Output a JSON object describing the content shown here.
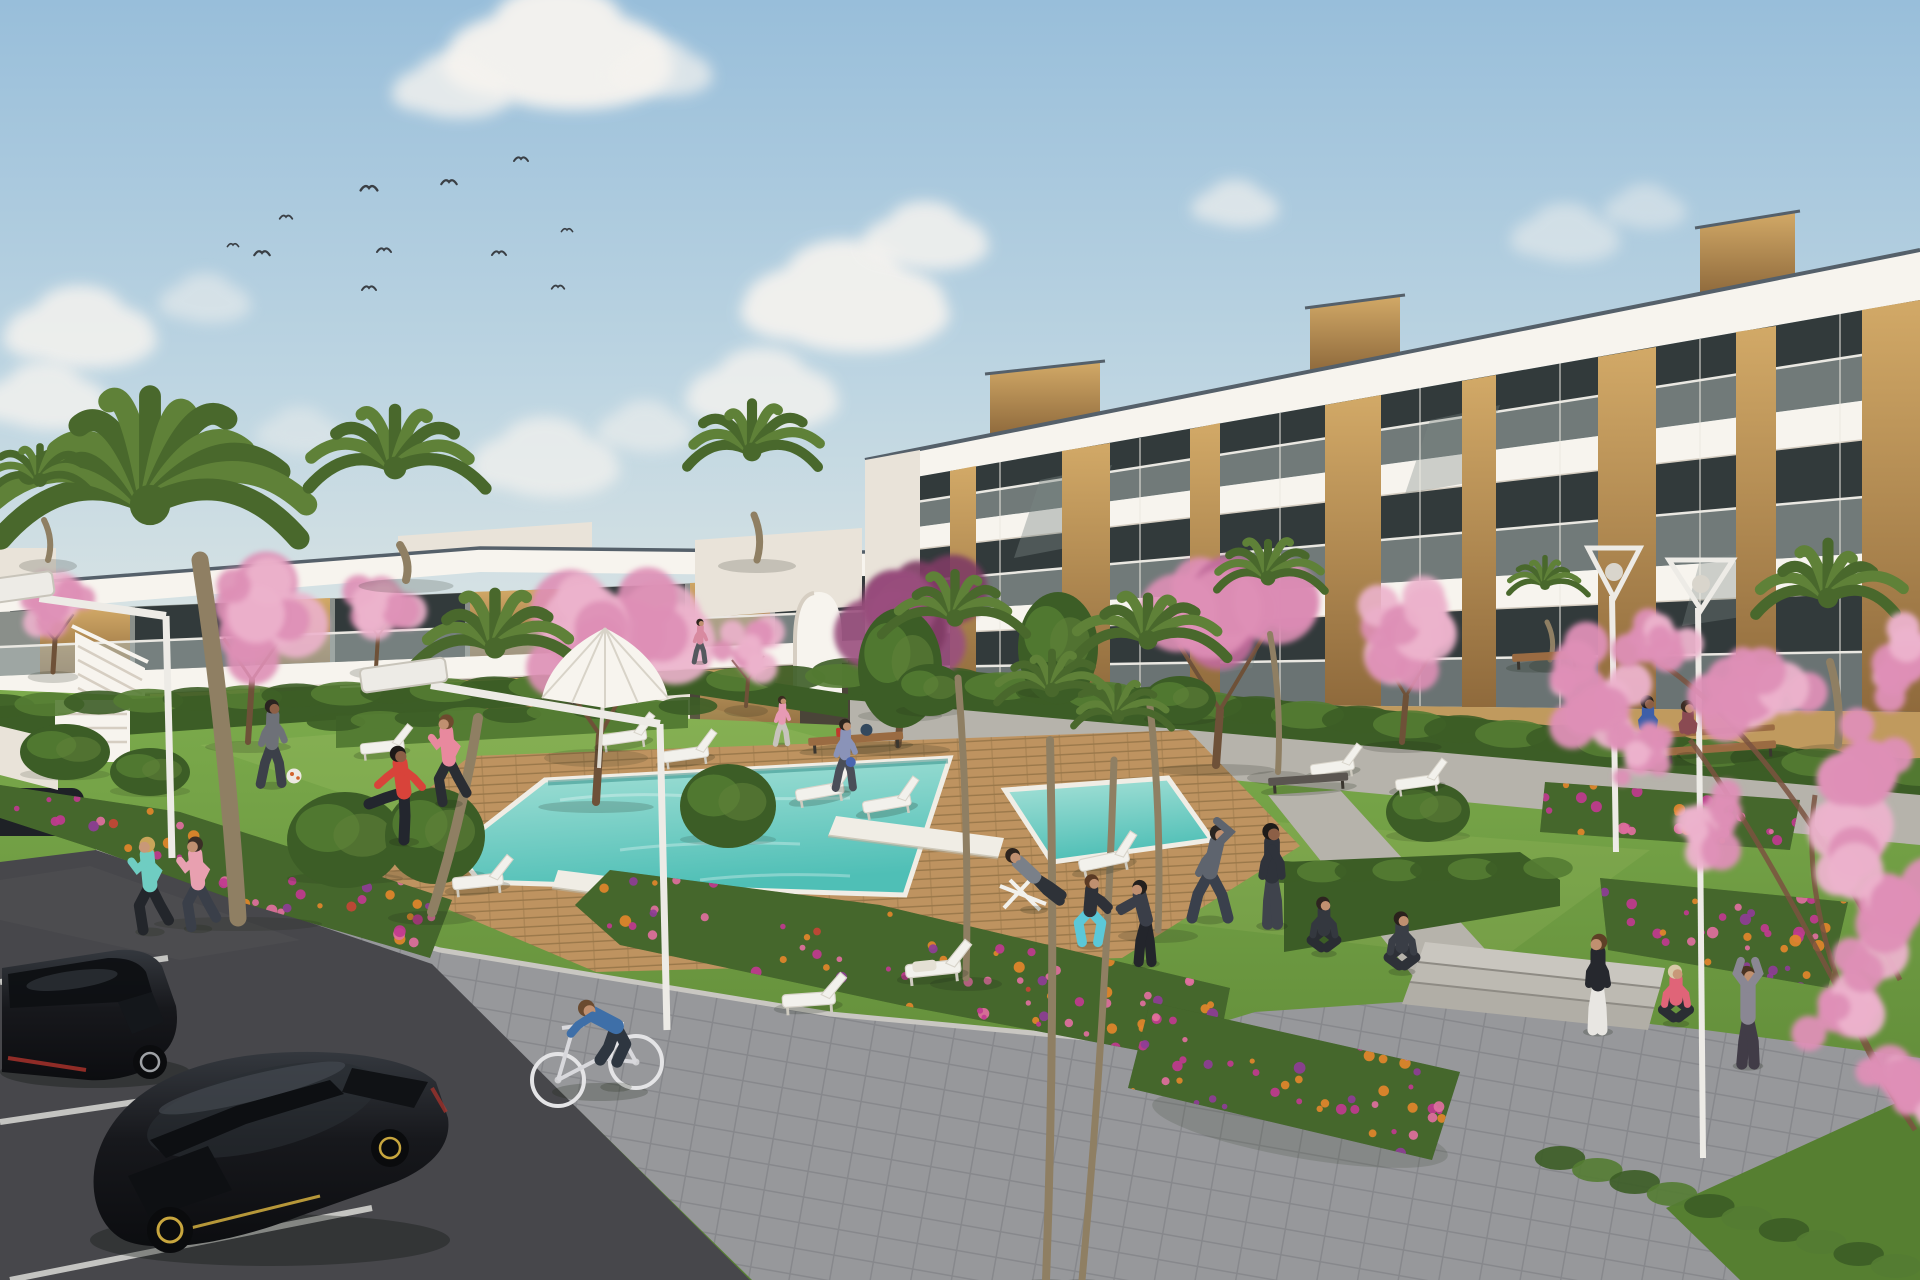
{
  "scene": {
    "type": "architectural-render",
    "subject": "modern white apartment complex with communal pool, gardens, parking and people exercising"
  },
  "palette": {
    "sky-top": "#98BEDA",
    "sky-mid": "#BFD6E2",
    "sky-horizon": "#DAE4E4",
    "cloud": "#F5F3EF",
    "bird": "#3A3F45",
    "white-sun": "#F7F4EE",
    "white-shade": "#E9E3D9",
    "slab-shadow": "#D6CEC2",
    "coping-dark": "#55606A",
    "glass-dark": "#323A3B",
    "glass-mid": "#5E6A68",
    "glass-ref": "#7A8784",
    "balustrade": "#AFBAB8",
    "rail": "#EAE8E2",
    "wood-light": "#D2A967",
    "wood-mid": "#BA8E52",
    "wood-dark": "#8F6A3C",
    "tan-wall": "#C09A5E",
    "hedge-dark": "#3C5D26",
    "hedge-light": "#547C33",
    "lawn-light": "#7CAB4C",
    "lawn-dark": "#567F31",
    "lawn-deep": "#486E2A",
    "sun-patch": "#D9E48A",
    "deck-light": "#BE9360",
    "deck-dark": "#9A784A",
    "pool-far": "#A9E2D8",
    "pool-near": "#4FBFB6",
    "pool-shadow": "#2E8A84",
    "coping": "#F0EDE5",
    "flower-orange": "#E2862B",
    "flower-pink": "#E06F9E",
    "flower-magenta": "#C0398F",
    "flower-violet": "#8E3D96",
    "flower-red": "#C44536",
    "bed-green": "#3E5D28",
    "blossom-light": "#ECB3CC",
    "blossom-mid": "#DE8FB6",
    "blossom-deep": "#C06A9A",
    "leaf-purple": "#9A4F7E",
    "leaf-purple-dark": "#7E3C64",
    "palm-green": "#5F8138",
    "palm-dark": "#49682C",
    "trunk": "#8F7F63",
    "branch": "#7A5240",
    "asphalt": "#47474B",
    "asphalt-light": "#55555A",
    "line-white": "#DADAD6",
    "curb": "#C9C7C2",
    "paver": "#97989B",
    "paver-line": "#87888C",
    "concrete": "#B6B3AB",
    "step-light": "#C9C6BF",
    "step-mid": "#BDBAB2",
    "step-deep": "#B1AEA6",
    "lamp-white": "#EDEBE6",
    "lamp-shade": "#C8C4BA",
    "car-black": "#17181C",
    "car-high": "#3A4046",
    "car-glass": "#0E1013",
    "rim-silver": "#9FA2A6",
    "rim-yellow": "#C8A63E",
    "tail-red": "#B0342C",
    "bench-wood": "#9A6B42",
    "bench-dark": "#5A5550",
    "shadow": "#1A2414"
  },
  "clouds": [
    {
      "x": 558,
      "y": 52,
      "r": 105,
      "o": 0.97
    },
    {
      "x": 452,
      "y": 88,
      "r": 55,
      "o": 0.8
    },
    {
      "x": 660,
      "y": 70,
      "r": 48,
      "o": 0.7
    },
    {
      "x": 80,
      "y": 330,
      "r": 70,
      "o": 0.85
    },
    {
      "x": 45,
      "y": 398,
      "r": 58,
      "o": 0.8
    },
    {
      "x": 205,
      "y": 300,
      "r": 42,
      "o": 0.5
    },
    {
      "x": 545,
      "y": 460,
      "r": 68,
      "o": 0.7
    },
    {
      "x": 645,
      "y": 428,
      "r": 44,
      "o": 0.55
    },
    {
      "x": 300,
      "y": 432,
      "r": 40,
      "o": 0.4
    },
    {
      "x": 845,
      "y": 300,
      "r": 95,
      "o": 0.92
    },
    {
      "x": 762,
      "y": 392,
      "r": 70,
      "o": 0.8
    },
    {
      "x": 925,
      "y": 238,
      "r": 58,
      "o": 0.85
    },
    {
      "x": 1235,
      "y": 205,
      "r": 40,
      "o": 0.65
    },
    {
      "x": 1565,
      "y": 235,
      "r": 50,
      "o": 0.5
    },
    {
      "x": 1645,
      "y": 208,
      "r": 38,
      "o": 0.45
    }
  ],
  "birds": [
    {
      "x": 369,
      "y": 188,
      "s": 1.2
    },
    {
      "x": 449,
      "y": 182,
      "s": 1.1
    },
    {
      "x": 521,
      "y": 159,
      "s": 1.0
    },
    {
      "x": 286,
      "y": 217,
      "s": 0.9
    },
    {
      "x": 233,
      "y": 245,
      "s": 0.8
    },
    {
      "x": 262,
      "y": 253,
      "s": 1.1
    },
    {
      "x": 384,
      "y": 250,
      "s": 1.0
    },
    {
      "x": 499,
      "y": 253,
      "s": 1.0
    },
    {
      "x": 369,
      "y": 288,
      "s": 1.0
    },
    {
      "x": 558,
      "y": 287,
      "s": 0.9
    },
    {
      "x": 567,
      "y": 230,
      "s": 0.8
    }
  ],
  "palms": [
    {
      "x": 150,
      "y": 505,
      "r": 168,
      "t": [
        200,
        560,
        238,
        918
      ],
      "w": 17,
      "big": true
    },
    {
      "x": 40,
      "y": 480,
      "r": 58,
      "t": [
        44,
        520,
        48,
        560
      ],
      "w": 6
    },
    {
      "x": 395,
      "y": 468,
      "r": 95,
      "t": [
        400,
        545,
        406,
        580
      ],
      "w": 8
    },
    {
      "x": 752,
      "y": 452,
      "r": 78,
      "t": [
        754,
        515,
        757,
        560
      ],
      "w": 7
    },
    {
      "x": 495,
      "y": 648,
      "r": 88,
      "t": [
        478,
        718,
        432,
        912
      ],
      "w": 10
    },
    {
      "x": 955,
      "y": 618,
      "r": 72,
      "t": [
        958,
        678,
        966,
        978
      ],
      "w": 7
    },
    {
      "x": 1148,
      "y": 640,
      "r": 80,
      "t": [
        1150,
        706,
        1158,
        930
      ],
      "w": 7
    },
    {
      "x": 1052,
      "y": 690,
      "r": 60,
      "t": [
        1050,
        740,
        1046,
        1280
      ],
      "w": 8
    },
    {
      "x": 1118,
      "y": 716,
      "r": 54,
      "t": [
        1114,
        760,
        1082,
        1280
      ],
      "w": 7
    },
    {
      "x": 1268,
      "y": 578,
      "r": 62,
      "t": [
        1270,
        634,
        1278,
        772
      ],
      "w": 6
    },
    {
      "x": 1545,
      "y": 585,
      "r": 42,
      "t": [
        1547,
        622,
        1550,
        660
      ],
      "w": 5
    },
    {
      "x": 1828,
      "y": 598,
      "r": 85,
      "t": [
        1830,
        662,
        1838,
        745
      ],
      "w": 8
    }
  ],
  "blossoms": [
    {
      "x": 55,
      "y": 605,
      "r": 46,
      "c": "blossom-mid",
      "c2": "blossom-light",
      "t": [
        55,
        640,
        53,
        672
      ],
      "w": 5
    },
    {
      "x": 255,
      "y": 615,
      "r": 78,
      "c": "blossom-mid",
      "c2": "blossom-light",
      "t": [
        252,
        680,
        248,
        742
      ],
      "w": 6
    },
    {
      "x": 380,
      "y": 598,
      "r": 48,
      "c": "blossom-light",
      "c2": "blossom-mid",
      "t": [
        378,
        636,
        376,
        668
      ],
      "w": 4
    },
    {
      "x": 598,
      "y": 640,
      "r": 105,
      "c": "blossom-mid",
      "c2": "blossom-light",
      "t": [
        600,
        735,
        596,
        802
      ],
      "w": 8
    },
    {
      "x": 905,
      "y": 608,
      "r": 95,
      "c": "leaf-purple",
      "c2": "leaf-purple-dark",
      "t": [
        902,
        698,
        898,
        745
      ],
      "w": 7
    },
    {
      "x": 748,
      "y": 648,
      "r": 40,
      "c": "blossom-light",
      "c2": "blossom-mid",
      "t": [
        748,
        680,
        746,
        706
      ],
      "w": 4
    },
    {
      "x": 1222,
      "y": 612,
      "r": 108,
      "c": "blossom-mid",
      "c2": "blossom-deep",
      "t": [
        1220,
        710,
        1216,
        765
      ],
      "w": 8
    },
    {
      "x": 1408,
      "y": 630,
      "r": 72,
      "c": "blossom-light",
      "c2": "blossom-mid",
      "t": [
        1406,
        696,
        1402,
        742
      ],
      "w": 6
    }
  ],
  "bushes": [
    {
      "x": 900,
      "y": 668,
      "rx": 42,
      "ry": 60
    },
    {
      "x": 1058,
      "y": 648,
      "rx": 40,
      "ry": 56
    },
    {
      "x": 345,
      "y": 840,
      "rx": 58,
      "ry": 48
    },
    {
      "x": 435,
      "y": 836,
      "rx": 50,
      "ry": 48
    },
    {
      "x": 728,
      "y": 806,
      "rx": 48,
      "ry": 42
    },
    {
      "x": 1428,
      "y": 812,
      "rx": 42,
      "ry": 30
    },
    {
      "x": 65,
      "y": 752,
      "rx": 45,
      "ry": 28
    },
    {
      "x": 150,
      "y": 772,
      "rx": 40,
      "ry": 24
    },
    {
      "x": 930,
      "y": 690,
      "rx": 34,
      "ry": 26
    },
    {
      "x": 1180,
      "y": 700,
      "rx": 36,
      "ry": 24
    }
  ],
  "hedges": [
    {
      "x1": 848,
      "y1": 672,
      "x2": 1920,
      "y2": 772,
      "n": 22,
      "ry": 14
    },
    {
      "x1": 0,
      "y1": 706,
      "x2": 840,
      "y2": 676,
      "n": 18,
      "ry": 12
    },
    {
      "x1": 336,
      "y1": 722,
      "x2": 688,
      "y2": 706,
      "n": 9,
      "ry": 9
    },
    {
      "x1": 1284,
      "y1": 872,
      "x2": 1548,
      "y2": 868,
      "n": 8,
      "ry": 11
    },
    {
      "x1": 1560,
      "y1": 1158,
      "x2": 1896,
      "y2": 1266,
      "n": 10,
      "ry": 12
    }
  ],
  "flower_beds": [
    {
      "name": "bed-left",
      "points": "0,785 180,812 330,860 452,900 430,958 240,902 92,848 0,818",
      "dots": [
        [
          "flower-orange",
          40
        ],
        [
          "flower-pink",
          30
        ],
        [
          "flower-magenta",
          26
        ],
        [
          "flower-violet",
          16
        ],
        [
          "flower-red",
          10
        ]
      ]
    },
    {
      "name": "bed-center",
      "points": "610,870 880,905 1230,988 1215,1065 900,1005 620,945 575,905",
      "dots": [
        [
          "flower-orange",
          44
        ],
        [
          "flower-pink",
          34
        ],
        [
          "flower-magenta",
          30
        ],
        [
          "flower-violet",
          18
        ],
        [
          "flower-red",
          10
        ]
      ]
    },
    {
      "name": "bed-right-low",
      "points": "1150,1002 1460,1072 1432,1160 1128,1088",
      "dots": [
        [
          "flower-magenta",
          24
        ],
        [
          "flower-orange",
          20
        ],
        [
          "flower-violet",
          16
        ],
        [
          "flower-pink",
          12
        ]
      ]
    },
    {
      "name": "bed-right-hedge",
      "points": "1545,782 1800,800 1790,850 1540,832",
      "dots": [
        [
          "flower-magenta",
          16
        ],
        [
          "flower-pink",
          12
        ],
        [
          "flower-orange",
          8
        ]
      ]
    },
    {
      "name": "bed-right-mid",
      "points": "1600,878 1848,902 1828,988 1608,950",
      "dots": [
        [
          "flower-magenta",
          18
        ],
        [
          "flower-orange",
          14
        ],
        [
          "flower-violet",
          10
        ],
        [
          "flower-pink",
          8
        ]
      ]
    }
  ],
  "loungers": [
    {
      "x": 600,
      "y": 735,
      "a": -8,
      "s": 1.0
    },
    {
      "x": 662,
      "y": 752,
      "a": -8,
      "s": 1.0
    },
    {
      "x": 795,
      "y": 790,
      "a": -10,
      "s": 1.05
    },
    {
      "x": 862,
      "y": 802,
      "a": -10,
      "s": 1.05
    },
    {
      "x": 1078,
      "y": 860,
      "a": -12,
      "s": 1.1
    },
    {
      "x": 1310,
      "y": 765,
      "a": -8,
      "s": 0.95
    },
    {
      "x": 1395,
      "y": 780,
      "a": -8,
      "s": 0.95
    },
    {
      "x": 905,
      "y": 965,
      "a": -6,
      "s": 1.2,
      "cushion": true
    },
    {
      "x": 782,
      "y": 995,
      "a": -4,
      "s": 1.15,
      "chair": true
    },
    {
      "x": 452,
      "y": 878,
      "a": -6,
      "s": 1.1
    },
    {
      "x": 360,
      "y": 744,
      "a": -6,
      "s": 0.95
    }
  ],
  "benches": [
    {
      "x": 808,
      "y": 738,
      "w": 95,
      "a": -4,
      "items": true
    },
    {
      "x": 1268,
      "y": 778,
      "w": 80,
      "a": -4,
      "dark": true
    },
    {
      "x": 1512,
      "y": 654,
      "w": 68,
      "a": -3
    },
    {
      "x": 1664,
      "y": 748,
      "w": 112,
      "a": -4,
      "back": true
    }
  ],
  "lamps": [
    {
      "type": "cantilever",
      "head": [
        405,
        685
      ],
      "pole": [
        660,
        724,
        667,
        1030
      ],
      "hw": 86
    },
    {
      "type": "cantilever-left",
      "head": [
        16,
        598
      ],
      "pole": [
        166,
        616,
        172,
        858
      ],
      "hw": 78
    },
    {
      "type": "cone",
      "cx": 1701,
      "top": 560,
      "w": 64,
      "pole": [
        1698,
        608,
        1703,
        1158
      ]
    },
    {
      "type": "cone",
      "cx": 1614,
      "top": 548,
      "w": 52,
      "pole": [
        1612,
        596,
        1616,
        852
      ]
    }
  ],
  "people": [
    {
      "name": "man-football",
      "x": 272,
      "y": 784,
      "s": 0.88,
      "pose": "walk",
      "top": "#6E7178",
      "bottom": "#3C4049",
      "skin": "#8C5F46",
      "hair": "#2A2320"
    },
    {
      "name": "man-red-stretch",
      "x": 404,
      "y": 840,
      "s": 1.0,
      "pose": "kick",
      "top": "#D8433A",
      "bottom": "#23262E",
      "skin": "#8C5F46",
      "hair": "#1E1A18"
    },
    {
      "name": "woman-pink-jogger-deck",
      "x": 449,
      "y": 802,
      "s": 0.92,
      "pose": "run",
      "top": "#E8899E",
      "bottom": "#2A2D33",
      "skin": "#C09070",
      "hair": "#6E4A2E",
      "flip": true
    },
    {
      "name": "jogger-teal",
      "x": 150,
      "y": 930,
      "s": 0.98,
      "pose": "run",
      "top": "#6FCDC2",
      "bottom": "#23262B",
      "skin": "#C89878",
      "hair": "#C9A55A",
      "flip": true
    },
    {
      "name": "jogger-pink",
      "x": 198,
      "y": 927,
      "s": 0.95,
      "pose": "run",
      "top": "#E8A0B0",
      "bottom": "#3A3F49",
      "skin": "#C09070",
      "hair": "#3A2E26",
      "flip": true
    },
    {
      "name": "man-deckchair",
      "x": 1034,
      "y": 908,
      "s": 0.92,
      "pose": "recline",
      "top": "#7A8089",
      "bottom": "#2E3238",
      "skin": "#C09070",
      "hair": "#2E241E"
    },
    {
      "name": "woman-squat-teal",
      "x": 1090,
      "y": 944,
      "s": 0.88,
      "pose": "squat",
      "top": "#2E3138",
      "bottom": "#5BC8D8",
      "skin": "#C09070",
      "hair": "#5A3A24"
    },
    {
      "name": "person-hoodie",
      "x": 1146,
      "y": 962,
      "s": 0.92,
      "pose": "lean",
      "top": "#3A3E48",
      "bottom": "#23252B",
      "skin": "#C09070",
      "hair": "#23201E",
      "flip": true
    },
    {
      "name": "man-stretch-side",
      "x": 1210,
      "y": 918,
      "s": 1.0,
      "pose": "stretch",
      "top": "#5E646E",
      "bottom": "#3A404C",
      "skin": "#C09070",
      "hair": "#2A2522"
    },
    {
      "name": "man-stand-dark",
      "x": 1272,
      "y": 924,
      "s": 1.05,
      "pose": "stand",
      "top": "#2F333B",
      "bottom": "#3F434C",
      "skin": "#8C5F46",
      "hair": "#1E1B19"
    },
    {
      "name": "woman-sit-exercise",
      "x": 1324,
      "y": 952,
      "s": 0.85,
      "pose": "sit",
      "top": "#34383F",
      "bottom": "#2A2D33",
      "skin": "#C09070",
      "hair": "#2E2420"
    },
    {
      "name": "woman-yoga-grass",
      "x": 1402,
      "y": 970,
      "s": 0.9,
      "pose": "sit",
      "top": "#3A3E46",
      "bottom": "#2E3138",
      "skin": "#C09070",
      "hair": "#2A211C"
    },
    {
      "name": "bench-person-blue",
      "x": 1648,
      "y": 752,
      "s": 0.82,
      "pose": "bench",
      "top": "#3E5FA8",
      "bottom": "#2E3238",
      "skin": "#8C5F46",
      "hair": "#1E1A18"
    },
    {
      "name": "bench-person-red",
      "x": 1688,
      "y": 754,
      "s": 0.78,
      "pose": "bench",
      "top": "#8A4A52",
      "bottom": "#2E3238",
      "skin": "#C09070",
      "hair": "#3A2C22"
    },
    {
      "name": "woman-stand-leggings",
      "x": 1598,
      "y": 1030,
      "s": 1.0,
      "pose": "stand",
      "top": "#26282E",
      "bottom": "#E8E6E2",
      "skin": "#C09070",
      "hair": "#5E4026",
      "flip": true
    },
    {
      "name": "woman-sit-pink",
      "x": 1676,
      "y": 1022,
      "s": 0.88,
      "pose": "sit",
      "top": "#E06478",
      "bottom": "#2A2D33",
      "skin": "#C89878",
      "hair": "#D8C9A8"
    },
    {
      "name": "woman-arms-up",
      "x": 1748,
      "y": 1064,
      "s": 1.02,
      "pose": "armsup",
      "top": "#8A8793",
      "bottom": "#413C47",
      "skin": "#C09070",
      "hair": "#4A3322"
    },
    {
      "name": "child-pink",
      "x": 782,
      "y": 744,
      "s": 0.5,
      "pose": "walk",
      "top": "#E79AB4",
      "bottom": "#C7C3BD",
      "skin": "#C09070",
      "hair": "#3A2C20"
    },
    {
      "name": "walker-blue-bag",
      "x": 845,
      "y": 788,
      "s": 0.72,
      "pose": "walk",
      "top": "#8A93B8",
      "bottom": "#4A4E58",
      "skin": "#C09070",
      "hair": "#2E241E"
    },
    {
      "name": "walker-path",
      "x": 700,
      "y": 662,
      "s": 0.45,
      "pose": "walk",
      "top": "#D88AA0",
      "bottom": "#55585E",
      "skin": "#C09070",
      "hair": "#2E241E"
    },
    {
      "name": "cyclist",
      "x": 616,
      "y": 1085,
      "s": 1.05,
      "pose": "cycle",
      "top": "#3E6FA8",
      "bottom": "#2E3640",
      "skin": "#C09070",
      "hair": "#6B4B30"
    }
  ],
  "fg_blossoms": [
    {
      "x": 1585,
      "y": 690,
      "r": 58
    },
    {
      "x": 1660,
      "y": 640,
      "r": 44
    },
    {
      "x": 1640,
      "y": 760,
      "r": 40
    },
    {
      "x": 1710,
      "y": 820,
      "r": 50
    },
    {
      "x": 1760,
      "y": 700,
      "r": 68
    },
    {
      "x": 1852,
      "y": 780,
      "r": 85
    },
    {
      "x": 1900,
      "y": 660,
      "r": 55
    },
    {
      "x": 1890,
      "y": 900,
      "r": 75
    },
    {
      "x": 1835,
      "y": 1000,
      "r": 60
    },
    {
      "x": 1905,
      "y": 1085,
      "r": 55
    }
  ]
}
